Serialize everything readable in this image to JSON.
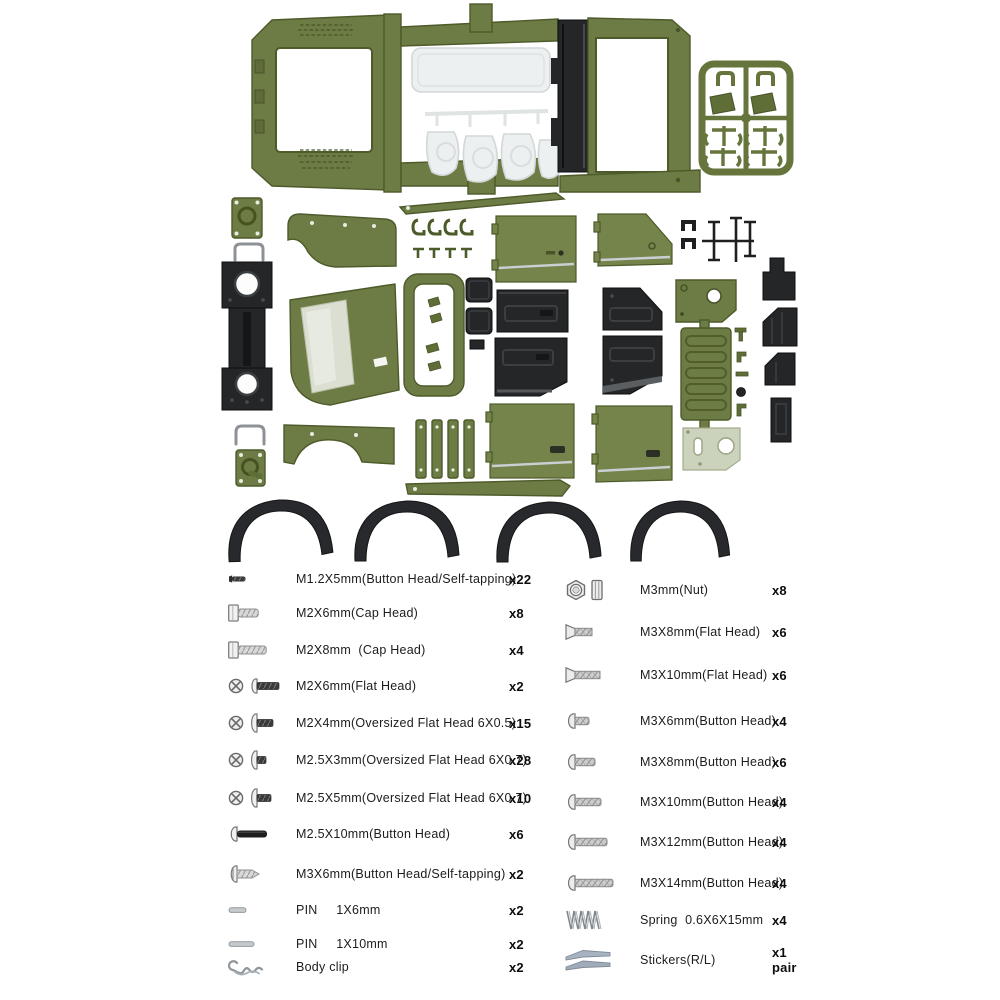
{
  "page": {
    "background": "#ffffff",
    "description": "RC crawler body shell kit parts spread with hardware list"
  },
  "illustration": {
    "colors": {
      "olive_body": "#6d7c45",
      "olive_dark": "#4d5a2a",
      "black_plastic": "#242628",
      "clear_plastic": "#edf0f0",
      "pale_green_bracket": "#ccd3bd",
      "sticker_gray_blue": "#a7b3c0"
    },
    "parts": [
      "body-shell-frame",
      "clear-window-parts",
      "black-roll-channel",
      "green-parts-sprue",
      "mount-plates",
      "u-wires",
      "black-slider-rail",
      "front-fender",
      "rear-fender",
      "windshield-frame",
      "window-frame-ring",
      "door-panels-green",
      "door-panels-black",
      "tailgate",
      "brackets",
      "rocker-sills",
      "fender-flares",
      "small-black-brackets"
    ]
  },
  "hardware_list": {
    "left": [
      {
        "label": "M1.2X5mm(Button Head/Self-tapping)",
        "qty": "x22"
      },
      {
        "label": "M2X6mm(Cap Head)",
        "qty": "x8"
      },
      {
        "label": "M2X8mm  (Cap Head)",
        "qty": "x4"
      },
      {
        "label": "M2X6mm(Flat Head)",
        "qty": "x2"
      },
      {
        "label": "M2X4mm(Oversized Flat Head 6X0.5)",
        "qty": "x15"
      },
      {
        "label": "M2.5X3mm(Oversized Flat Head 6X0.7)",
        "qty": "x28"
      },
      {
        "label": "M2.5X5mm(Oversized Flat Head 6X0.7)",
        "qty": "x10"
      },
      {
        "label": "M2.5X10mm(Button Head)",
        "qty": "x6"
      },
      {
        "label": "M3X6mm(Button Head/Self-tapping)",
        "qty": "x2"
      },
      {
        "label": "PIN     1X6mm",
        "qty": "x2"
      },
      {
        "label": "PIN     1X10mm",
        "qty": "x2"
      },
      {
        "label": "Body clip",
        "qty": "x2"
      }
    ],
    "right": [
      {
        "label": "M3mm(Nut)",
        "qty": "x8"
      },
      {
        "label": "M3X8mm(Flat Head)",
        "qty": "x6"
      },
      {
        "label": "M3X10mm(Flat Head)",
        "qty": "x6"
      },
      {
        "label": "M3X6mm(Button Head)",
        "qty": "x4"
      },
      {
        "label": "M3X8mm(Button Head)",
        "qty": "x6"
      },
      {
        "label": "M3X10mm(Button Head)",
        "qty": "x4"
      },
      {
        "label": "M3X12mm(Button Head)",
        "qty": "x4"
      },
      {
        "label": "M3X14mm(Button Head)",
        "qty": "x4"
      },
      {
        "label": "Spring  0.6X6X15mm",
        "qty": "x4"
      },
      {
        "label": "Stickers(R/L)",
        "qty": "x1 pair"
      }
    ]
  }
}
